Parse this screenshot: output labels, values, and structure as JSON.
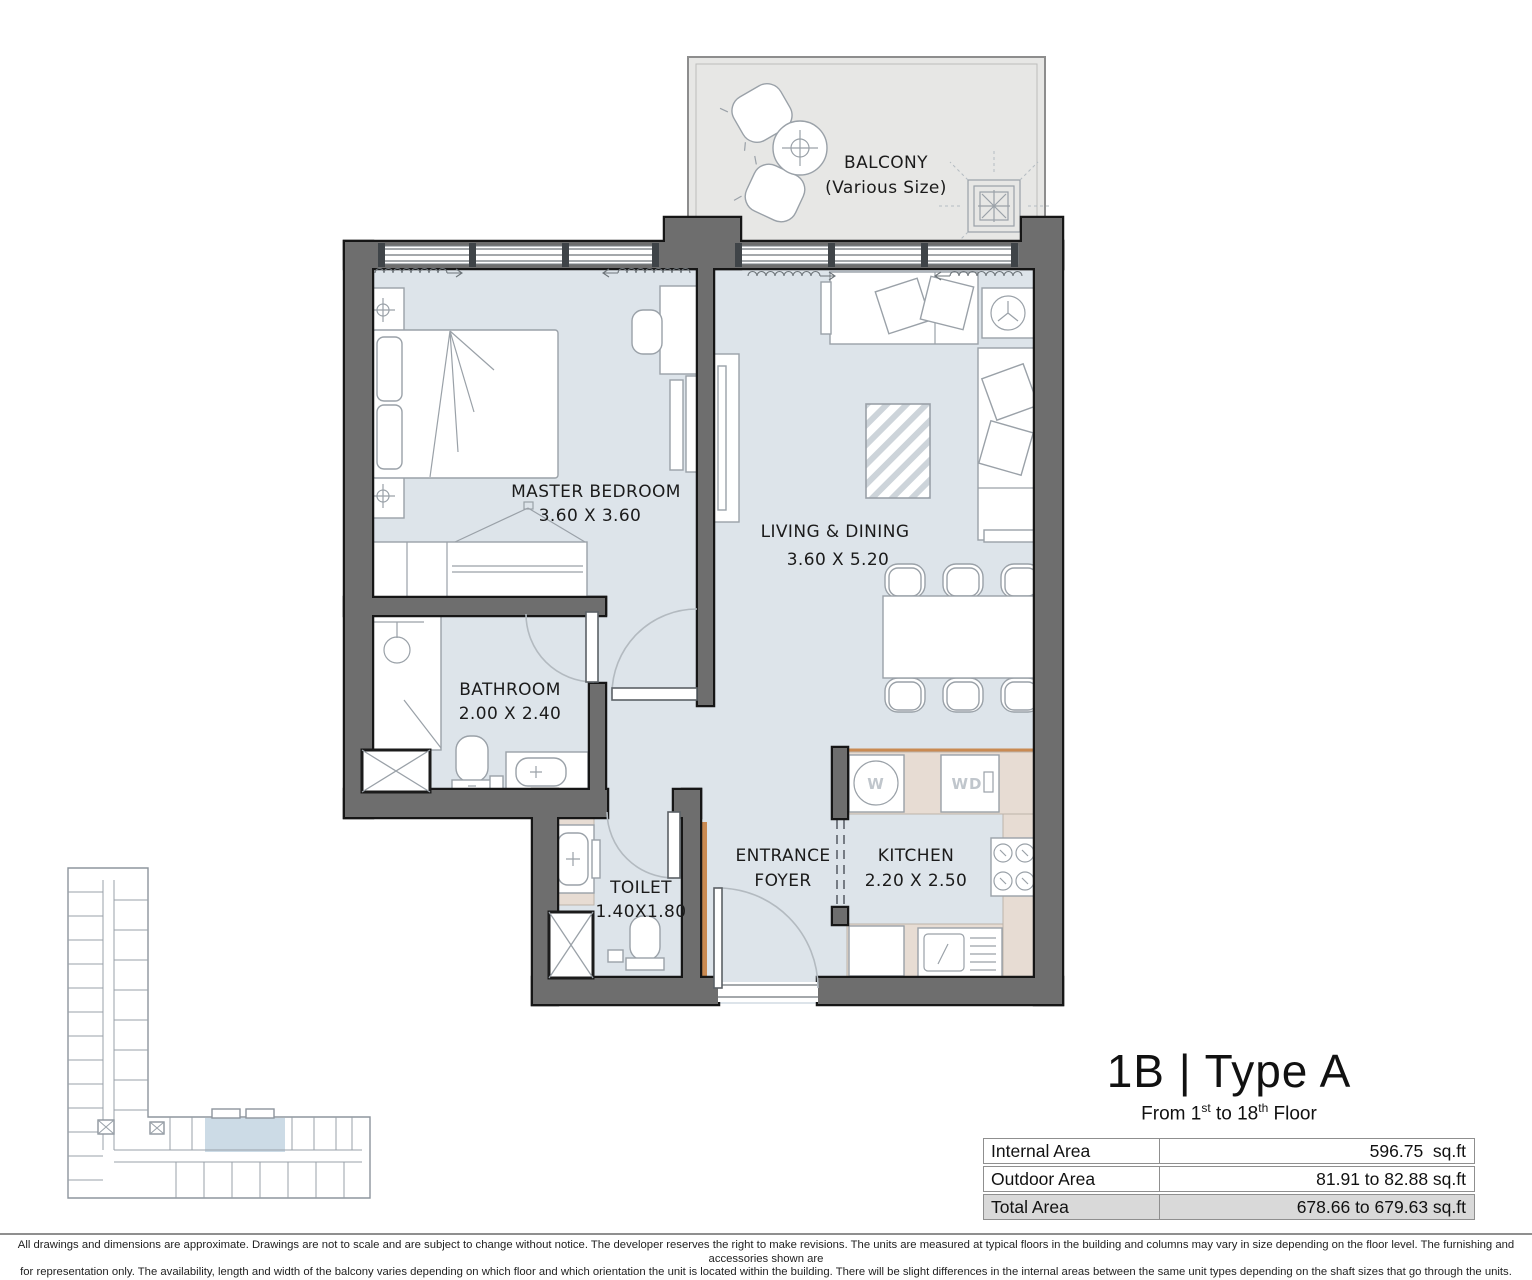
{
  "plan": {
    "balcony": {
      "name": "BALCONY",
      "size_note": "(Various Size)"
    },
    "rooms": [
      {
        "name": "MASTER BEDROOM",
        "dims": "3.60 X 3.60"
      },
      {
        "name": "LIVING & DINING",
        "dims": "3.60 X 5.20"
      },
      {
        "name": "BATHROOM",
        "dims": "2.00 X 2.40"
      },
      {
        "name": "TOILET",
        "dims": "1.40X1.80"
      },
      {
        "line1": "ENTRANCE",
        "line2": "FOYER"
      },
      {
        "name": "KITCHEN",
        "dims": "2.20 X 2.50"
      }
    ],
    "appliances": {
      "washer": "W",
      "dishwasher": "WD"
    }
  },
  "unit": {
    "title": "1B | Type A",
    "floor_range": {
      "prefix": "From 1",
      "sup1": "st",
      "mid": " to 18",
      "sup2": "th",
      "suffix": " Floor"
    }
  },
  "areas": {
    "rows": [
      {
        "label": "Internal Area",
        "value": "596.75  sq.ft"
      },
      {
        "label": "Outdoor Area",
        "value": "81.91 to 82.88 sq.ft"
      },
      {
        "label": "Total Area",
        "value": "678.66 to 679.63 sq.ft"
      }
    ]
  },
  "disclaimer": {
    "line1": "All drawings and dimensions are approximate. Drawings are not to scale and are subject to change without notice. The developer reserves the right to make revisions. The units are measured at typical floors in the building and columns may vary in size depending on the floor level. The furnishing and accessories shown are",
    "line2": "for representation only. The availability, length and width of the balcony varies depending on which floor and which orientation the unit is located within the building. There will be slight differences in the internal areas between the same unit types depending on the shaft sizes that go through the units."
  },
  "colors": {
    "wall": "#6e6e6e",
    "floor": "#dde4ea",
    "balcony-floor": "#e7e7e5",
    "counter": "#e7dcd3",
    "accent-wood": "#c98a52",
    "keyplan-highlight": "#ccdbe6",
    "table-total-bg": "#d9d9d9",
    "table-border": "#8f8f8f"
  }
}
